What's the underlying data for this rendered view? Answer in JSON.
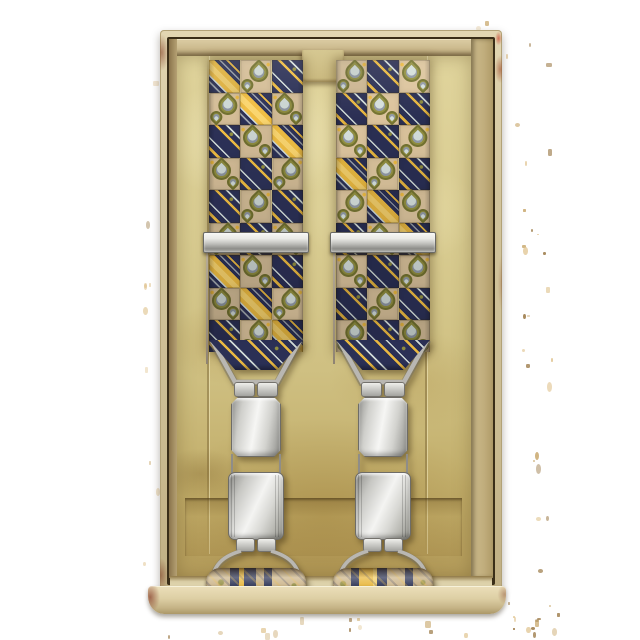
{
  "scene": {
    "description": "Pair of vintage suspenders with a yellow, navy and beige paisley checkerboard pattern, fitted with silver metal adjusters and clips, presented in an aged yellowed cardboard gift box",
    "components": {
      "box": "aged cardboard presentation box with paper insert",
      "straps": 2,
      "adjusters": 2,
      "top_clips": 2,
      "bottom_clips": 2,
      "rolled_strap_ends": 2
    }
  },
  "pattern": {
    "type": "checkerboard",
    "columns_per_strap": 3,
    "square_motifs": [
      "paisley-on-beige",
      "thin-diagonal-stripes-on-navy",
      "wide-yellow-diagonal-band"
    ],
    "stripe_angle_deg": 45
  },
  "palette": {
    "navy": "#2b3055",
    "yellow": "#e9b841",
    "yellowLight": "#f3cf6b",
    "beige": "#d6bf99",
    "olive": "#8e8c3f",
    "pale": "#cfd9d6",
    "grayStripe": "#9aa0a8",
    "paper": "#d8cc92",
    "paperDark": "#c2ad6c",
    "wallCream": "#d9cda9",
    "rust": "#7e4030",
    "metalBright": "#f5f5f3",
    "metalDark": "#8b8b87",
    "speckle": "#c8a76b",
    "speckleDark": "#97743f",
    "background": "#ffffff"
  }
}
